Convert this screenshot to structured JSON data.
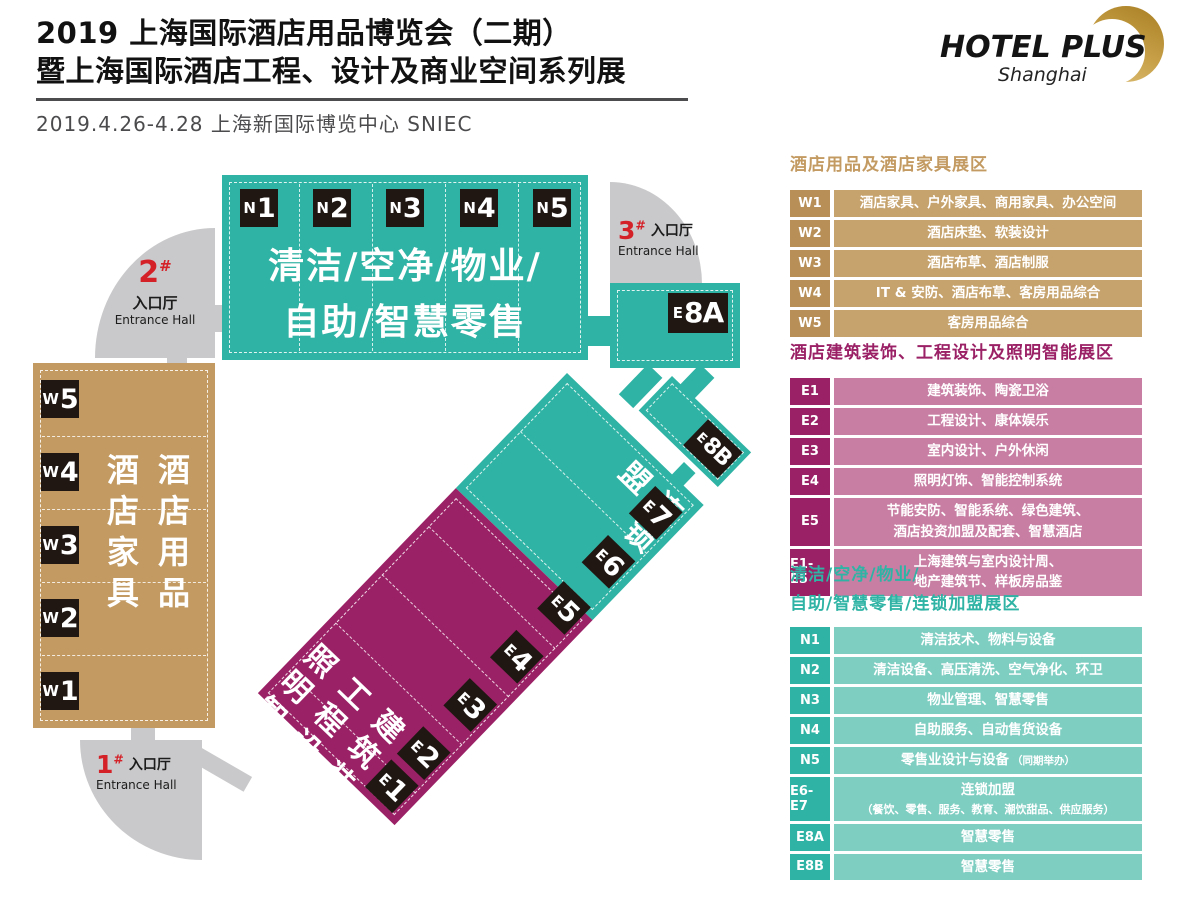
{
  "header": {
    "title_line1": "2019 上海国际酒店用品博览会（二期）",
    "title_line2": "暨上海国际酒店工程、设计及商业空间系列展",
    "date_venue": "2019.4.26-4.28  上海新国际博览中心  SNIEC",
    "logo": {
      "name": "HOTEL PLUS",
      "city": "Shanghai"
    }
  },
  "colors": {
    "teal": "#2FB3A4",
    "teal_light": "#7FCEC2",
    "magenta": "#9B2166",
    "magenta_light": "#C87EA3",
    "tan": "#C39B62",
    "tan_dark": "#B78F57",
    "tan_light": "#C6A26C",
    "corridor_gray": "#C9C9CB",
    "entrance_red": "#D42128",
    "tile_black": "#201713",
    "brand_gold": "#C8A149"
  },
  "map": {
    "entrances": {
      "e1": {
        "num": "1",
        "suffix": "#",
        "hall_cn": "入口厅",
        "hall_en": "Entrance Hall"
      },
      "e2": {
        "num": "2",
        "suffix": "#",
        "hall_cn": "入口厅",
        "hall_en": "Entrance Hall"
      },
      "e3": {
        "num": "3",
        "suffix": "#",
        "hall_cn": "入口厅",
        "hall_en": "Entrance Hall"
      }
    },
    "n_block": {
      "labels": [
        {
          "p": "N",
          "n": "1"
        },
        {
          "p": "N",
          "n": "2"
        },
        {
          "p": "N",
          "n": "3"
        },
        {
          "p": "N",
          "n": "4"
        },
        {
          "p": "N",
          "n": "5"
        }
      ],
      "line1": "清洁/空净/物业/",
      "line2": "自助/智慧零售"
    },
    "w_block": {
      "labels": [
        {
          "p": "W",
          "n": "5"
        },
        {
          "p": "W",
          "n": "4"
        },
        {
          "p": "W",
          "n": "3"
        },
        {
          "p": "W",
          "n": "2"
        },
        {
          "p": "W",
          "n": "1"
        }
      ],
      "col_right": "酒店用品",
      "col_left": "酒店家具"
    },
    "strip": {
      "teal_text": "连锁加盟",
      "magenta_cols": [
        "建筑装饰",
        "工程设计",
        "照明智能"
      ],
      "labels": [
        {
          "p": "E",
          "n": "7"
        },
        {
          "p": "E",
          "n": "6"
        },
        {
          "p": "E",
          "n": "5"
        },
        {
          "p": "E",
          "n": "4"
        },
        {
          "p": "E",
          "n": "3"
        },
        {
          "p": "E",
          "n": "2"
        },
        {
          "p": "E",
          "n": "1"
        }
      ]
    },
    "e8a": {
      "p": "E",
      "n": "8A"
    },
    "e8b": {
      "p": "E",
      "n": "8B"
    }
  },
  "legend": {
    "furniture": {
      "title": "酒店用品及酒店家具展区",
      "rows": [
        {
          "code": "W1",
          "desc": "酒店家具、户外家具、商用家具、办公空间"
        },
        {
          "code": "W2",
          "desc": "酒店床垫、软装设计"
        },
        {
          "code": "W3",
          "desc": "酒店布草、酒店制服"
        },
        {
          "code": "W4",
          "desc": "IT & 安防、酒店布草、客房用品综合"
        },
        {
          "code": "W5",
          "desc": "客房用品综合"
        }
      ]
    },
    "engineering": {
      "title": "酒店建筑装饰、工程设计及照明智能展区",
      "rows": [
        {
          "code": "E1",
          "desc": "建筑装饰、陶瓷卫浴"
        },
        {
          "code": "E2",
          "desc": "工程设计、康体娱乐"
        },
        {
          "code": "E3",
          "desc": "室内设计、户外休闲"
        },
        {
          "code": "E4",
          "desc": "照明灯饰、智能控制系统"
        },
        {
          "code": "E5",
          "desc": "节能安防、智能系统、绿色建筑、",
          "desc2": "酒店投资加盟及配套、智慧酒店"
        },
        {
          "code": "E1-E5",
          "desc": "上海建筑与室内设计周、",
          "desc2": "地产建筑节、样板房品鉴"
        }
      ]
    },
    "cleaning": {
      "title_line1": "清洁/空净/物业/",
      "title_line2": "自助/智慧零售/连锁加盟展区",
      "rows": [
        {
          "code": "N1",
          "desc": "清洁技术、物料与设备"
        },
        {
          "code": "N2",
          "desc": "清洁设备、高压清洗、空气净化、环卫"
        },
        {
          "code": "N3",
          "desc": "物业管理、智慧零售"
        },
        {
          "code": "N4",
          "desc": "自助服务、自动售货设备"
        },
        {
          "code": "N5",
          "desc": "零售业设计与设备",
          "note": "（同期举办）"
        },
        {
          "code": "E6-E7",
          "desc": "连锁加盟",
          "desc2": "（餐饮、零售、服务、教育、潮饮甜品、供应服务）"
        },
        {
          "code": "E8A",
          "desc": "智慧零售"
        },
        {
          "code": "E8B",
          "desc": "智慧零售"
        }
      ]
    }
  }
}
